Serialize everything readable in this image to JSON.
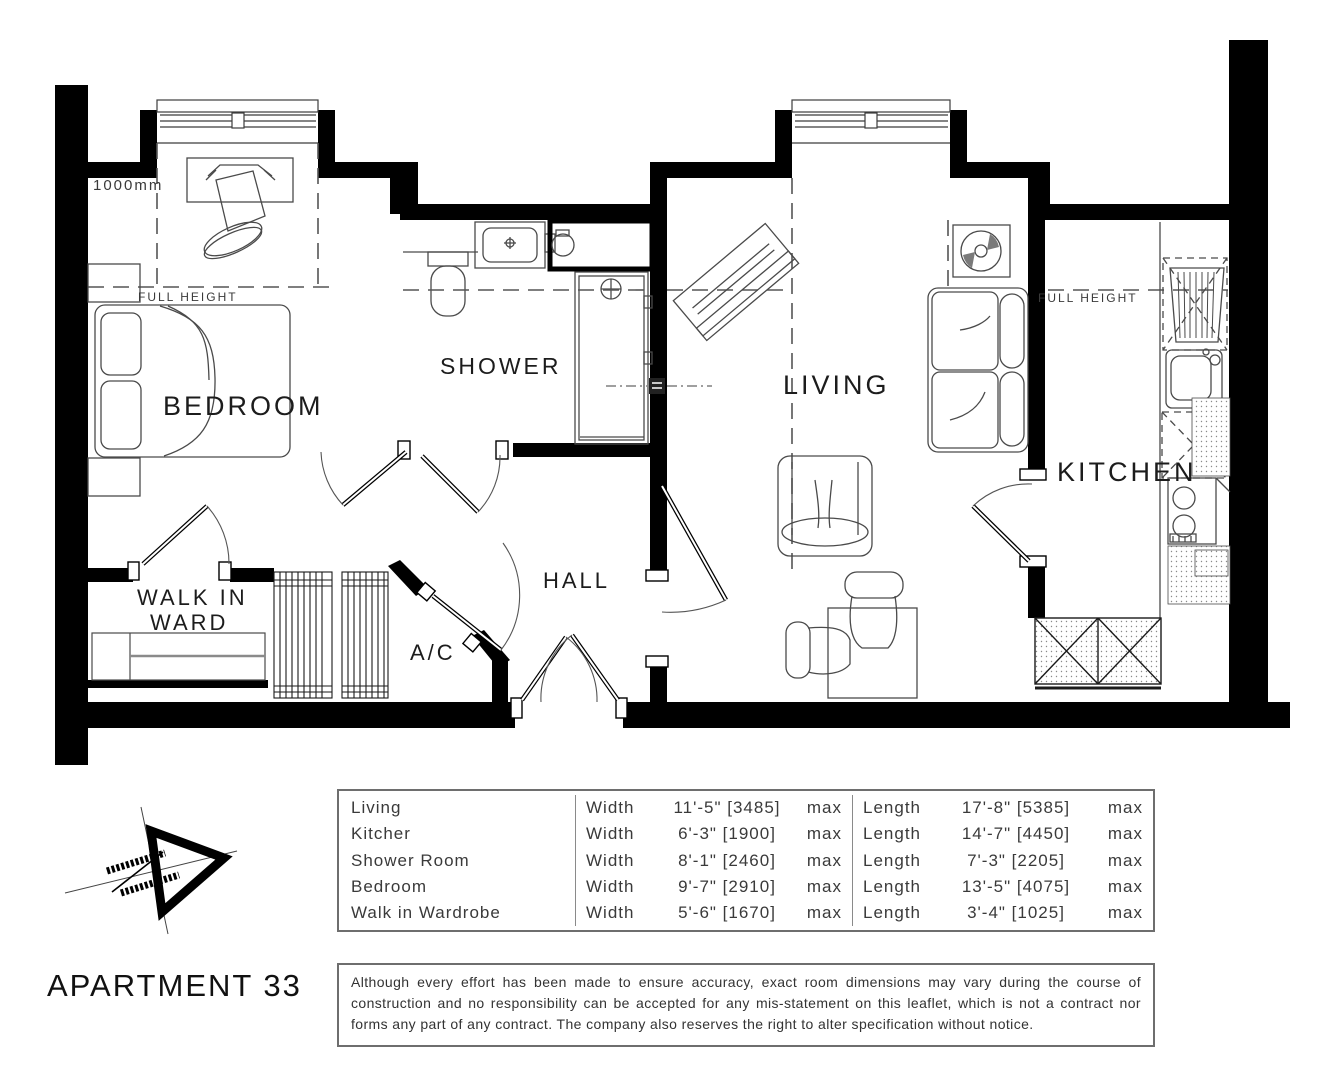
{
  "title": "APARTMENT 33",
  "plan": {
    "rooms": {
      "bedroom": "BEDROOM",
      "shower": "SHOWER",
      "living": "LIVING",
      "kitchen": "KITCHEN",
      "hall": "HALL",
      "ac": "A/C",
      "walk_in_ward_line1": "WALK IN",
      "walk_in_ward_line2": "WARD"
    },
    "annotations": {
      "dim_1000mm": "1000mm",
      "full_height_bedroom": "FULL HEIGHT",
      "full_height_kitchen": "FULL HEIGHT"
    },
    "icons": {
      "north_arrow": "north-arrow-triangle"
    },
    "colors": {
      "walls": "#000000",
      "furniture_lines": "#4a4a4a",
      "dashed_lines": "#555555"
    }
  },
  "dims_table": {
    "headers": {
      "width": "Width",
      "length": "Length",
      "max": "max"
    },
    "rows": [
      {
        "name": "Living",
        "width": "11'-5\" [3485]",
        "length": "17'-8\" [5385]"
      },
      {
        "name": "Kitcher",
        "width": "6'-3\" [1900]",
        "length": "14'-7\" [4450]"
      },
      {
        "name": "Shower Room",
        "width": "8'-1\" [2460]",
        "length": "7'-3\" [2205]"
      },
      {
        "name": "Bedroom",
        "width": "9'-7\" [2910]",
        "length": "13'-5\" [4075]"
      },
      {
        "name": "Walk in Wardrobe",
        "width": "5'-6\" [1670]",
        "length": "3'-4\" [1025]"
      }
    ]
  },
  "disclaimer": "Although every effort has been made to ensure accuracy, exact room dimensions may vary during the course of construction and no responsibility can be accepted for any mis-statement on this leaflet, which is not a contract nor forms any part of any contract. The company also reserves the right to alter specification without notice."
}
